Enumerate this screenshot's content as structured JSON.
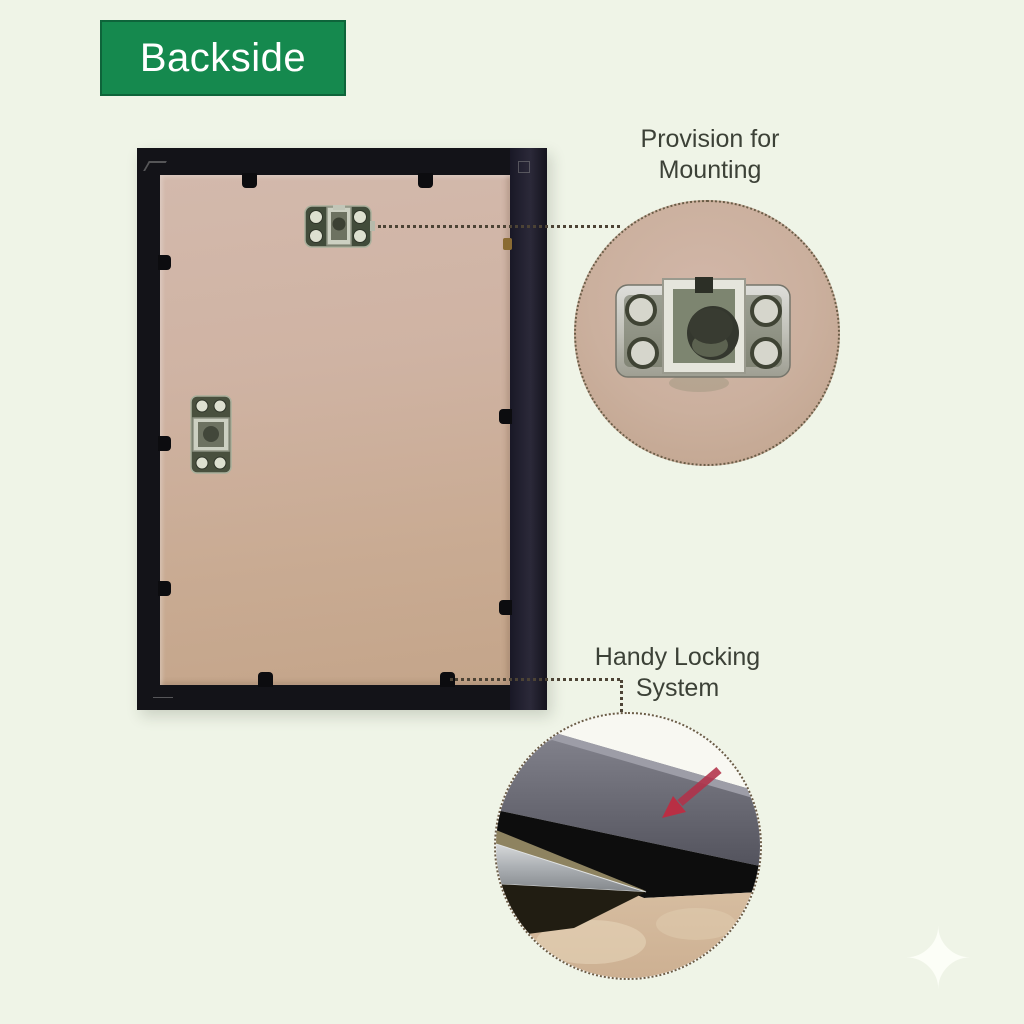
{
  "banner": {
    "label": "Backside"
  },
  "annotations": {
    "mounting": {
      "line1": "Provision for",
      "line2": "Mounting"
    },
    "locking": {
      "line1": "Handy Locking",
      "line2": "System"
    }
  },
  "icons": {
    "sparkle": {
      "name": "sparkle-icon",
      "glyph": "✦"
    }
  },
  "colors": {
    "background": "#eff4e7",
    "banner_green": "#15894e",
    "banner_text": "#ffffff",
    "frame_black": "#131318",
    "backboard_tan": "#cbae97",
    "annotation_text": "#3c4137",
    "leader_dots": "#4c4335",
    "arrow_red": "#b23249",
    "bracket_metal": "#c9c9c0"
  }
}
